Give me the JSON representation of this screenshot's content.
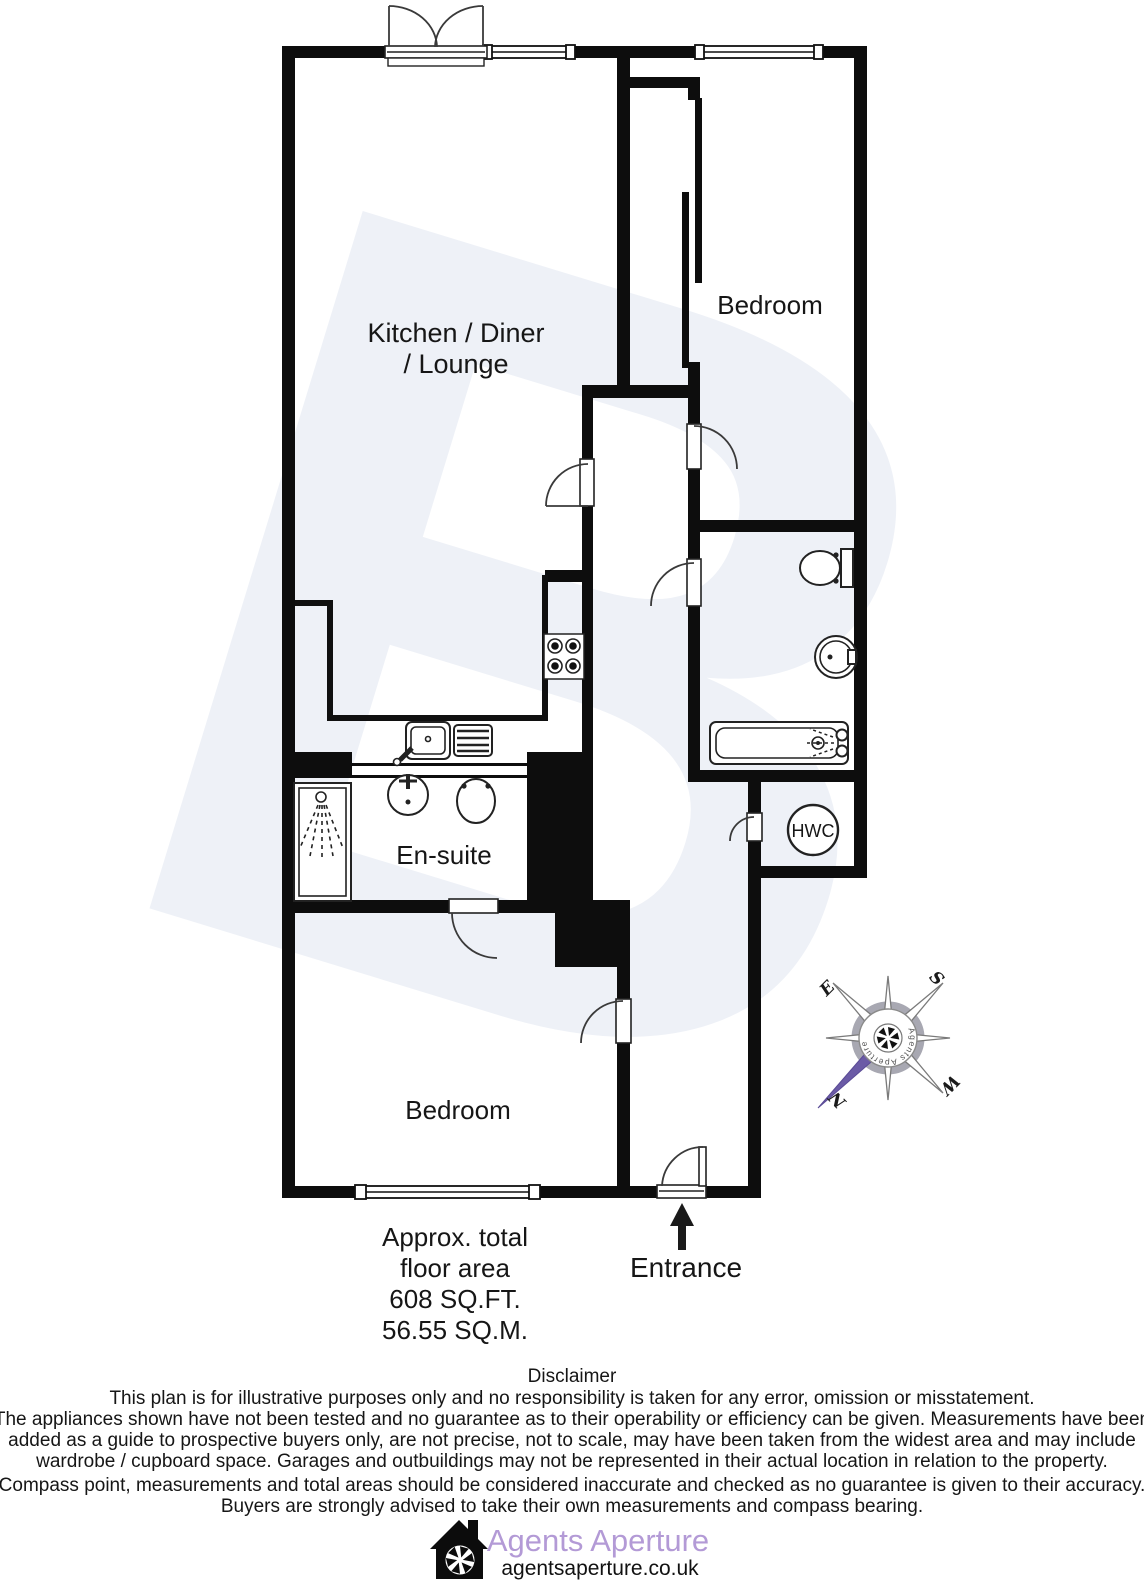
{
  "plan": {
    "rooms": {
      "kitchen_line1": "Kitchen / Diner",
      "kitchen_line2": "/ Lounge",
      "bedroom_top": "Bedroom",
      "bedroom_bottom": "Bedroom",
      "ensuite": "En-suite",
      "hwc": "HWC"
    },
    "entrance_label": "Entrance",
    "area_lines": [
      "Approx. total",
      "floor area",
      "608 SQ.FT.",
      "56.55 SQ.M."
    ]
  },
  "compass": {
    "north": "N",
    "east": "E",
    "south": "S",
    "west": "W",
    "ring_text": "Agents Aperture",
    "north_color": "#6b5ba6"
  },
  "disclaimer": {
    "title": "Disclaimer",
    "lines": [
      "This plan is for illustrative purposes only and no responsibility is taken for any error, omission or misstatement.",
      "The appliances shown have not been tested and no guarantee as to their operability or efficiency can be given. Measurements have been",
      "added as a guide to prospective buyers only, are not precise, not to scale, may have been taken from the widest area and may include",
      "wardrobe / cupboard space. Garages and outbuildings may not be represented in their actual location in relation to the property.",
      "Compass point, measurements and total areas should be considered inaccurate and checked as no guarantee is given to their accuracy.",
      "Buyers are strongly advised to take their own measurements and compass bearing."
    ]
  },
  "footer": {
    "brand": "Agents Aperture",
    "website": "agentsaperture.co.uk",
    "brand_color": "#b39ad6"
  },
  "colors": {
    "wall": "#0d0d0d",
    "watermark": "#eef1f7",
    "north_purple": "#6b5ba6"
  }
}
